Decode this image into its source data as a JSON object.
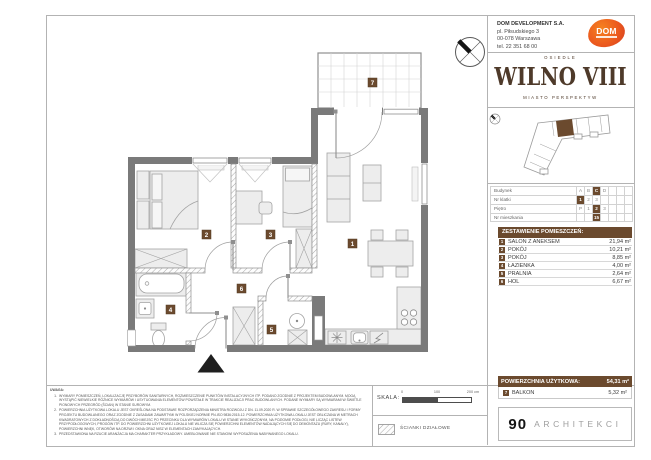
{
  "header": {
    "company": [
      "DOM DEVELOPMENT S.A.",
      "pl. Piłsudskiego 3",
      "00-078 Warszawa",
      "tel. 22 351 68 00"
    ],
    "logo_text": "DOM"
  },
  "brand": {
    "osiedle": "OSIEDLE",
    "name": "WILNO VIII",
    "tagline": "MIASTO PERSPEKTYW"
  },
  "location": {
    "rows": [
      {
        "label": "Budynek",
        "cells": [
          "A",
          "B",
          "C",
          "D",
          "",
          "",
          ""
        ],
        "selected_index": 2
      },
      {
        "label": "Nr klatki",
        "cells": [
          "1",
          "2",
          "3",
          "",
          "",
          "",
          ""
        ],
        "selected_index": 0
      },
      {
        "label": "Piętro",
        "cells": [
          "P",
          "1",
          "2",
          "3",
          "",
          "",
          ""
        ],
        "selected_index": 2
      },
      {
        "label": "Nr mieszkania",
        "cells": [
          "",
          "",
          "15",
          "",
          "",
          "",
          ""
        ],
        "selected_index": 2
      }
    ]
  },
  "rooms": {
    "title": "ZESTAWIENIE POMIESZCZEŃ:",
    "items": [
      {
        "no": "1",
        "name": "SALON Z ANEKSEM",
        "area": "21,94 m²"
      },
      {
        "no": "2",
        "name": "POKÓJ",
        "area": "10,21 m²"
      },
      {
        "no": "3",
        "name": "POKÓJ",
        "area": "8,85 m²"
      },
      {
        "no": "4",
        "name": "ŁAZIENKA",
        "area": "4,00 m²"
      },
      {
        "no": "5",
        "name": "PRALNIA",
        "area": "2,64 m²"
      },
      {
        "no": "6",
        "name": "HOL",
        "area": "6,67 m²"
      }
    ]
  },
  "summary": {
    "label": "POWIERZCHNIA UŻYTKOWA:",
    "value": "54,31 m²",
    "balcony": {
      "no": "7",
      "name": "BALKON",
      "area": "5,32 m²"
    }
  },
  "architects": {
    "number": "90",
    "name": "ARCHITEKCI"
  },
  "notes": {
    "heading": "UWAGA:",
    "items": [
      {
        "num": "1.",
        "text": "WYMIARY POMIESZCZEŃ, LOKALIZACJĘ PRZYBORÓW SANITARNYCH, ROZMIESZCZENIE PUNKTÓW INSTALACYJNYCH ITP. PODANO ZGODNIE Z PROJEKTEM BUDOWLANYM. MOGĄ WYSTĄPIĆ NIEWIELKIE RÓŻNICE WYMIARÓW I USYTUOWANIA ELEMENTÓW POWSTAŁE W TRAKCIE REALIZACJI PRAC BUDOWLANYCH. PODANE WYMIARY SĄ WYMIARAMI W ŚWIETLE PIONOWYCH PRZEGRÓD (ŚCIAN) W STANIE SUROWYM."
      },
      {
        "num": "2.",
        "text": "POWIERZCHNIA UŻYTKOWA LOKALU JEST OKREŚLONA NA PODSTAWIE ROZPORZĄDZENIA MINISTRA ROZWOJU Z DN. 11.09.2020 R. W SPRAWIE SZCZEGÓŁOWEGO ZAKRESU I FORMY PROJEKTU BUDOWLANEGO ORAZ ZGODNIE Z ZASADAMI ZAWARTYMI W POLSKIEJ NORMIE PN-ISO 9836:2015-12. POWIERZCHNIA UŻYTKOWA LOKALU JEST OBLICZANA W METRACH KWADRATOWYCH Z DOKŁADNOŚCIĄ DO DWÓCH MIEJSC PO PRZECINKU DLA WYMIARÓW LOKALU W STANIE WYKOŃCZONYM, NA POZIOMIE PODŁOGI, NIE LICZĄC LISTEW PRZYPODŁOGOWYCH, PROGÓW ITP. DO POWIERZCHNI UŻYTKOWEJ LOKALU NIE WLICZA SIĘ POWIERZCHNI ELEMENTÓW NADAJĄCYCH SIĘ DO DEMONTAŻU (RURY, KANAŁY), POWIERZCHNI WNĘK, OTWORÓW NA DRZWI I OKNA ORAZ NISZ W ELEMENTACH ZAMYKAJĄCYCH."
      },
      {
        "num": "3.",
        "text": "PRZEDSTAWIONA NA RZUCIE ARANŻACJA MA CHARAKTER PRZYKŁADOWY. UMEBLOWANIE NIE STANOWI WYPOSAŻENIA NABYWANEGO LOKALU."
      }
    ]
  },
  "scale": {
    "label": "SKALA:",
    "t0": "0",
    "t100": "100",
    "t200": "200 cm"
  },
  "legend": {
    "partitions": "ŚCIANKI DZIAŁOWE"
  },
  "plan": {
    "badges": [
      {
        "n": "1"
      },
      {
        "n": "2"
      },
      {
        "n": "3"
      },
      {
        "n": "4"
      },
      {
        "n": "5"
      },
      {
        "n": "6"
      },
      {
        "n": "7"
      }
    ]
  },
  "colors": {
    "accent_brown": "#6b4a2e",
    "logo_brown": "#4e3a2a",
    "wall_gray": "#7a7a7a",
    "dom_orange": "#ec5a1e"
  }
}
